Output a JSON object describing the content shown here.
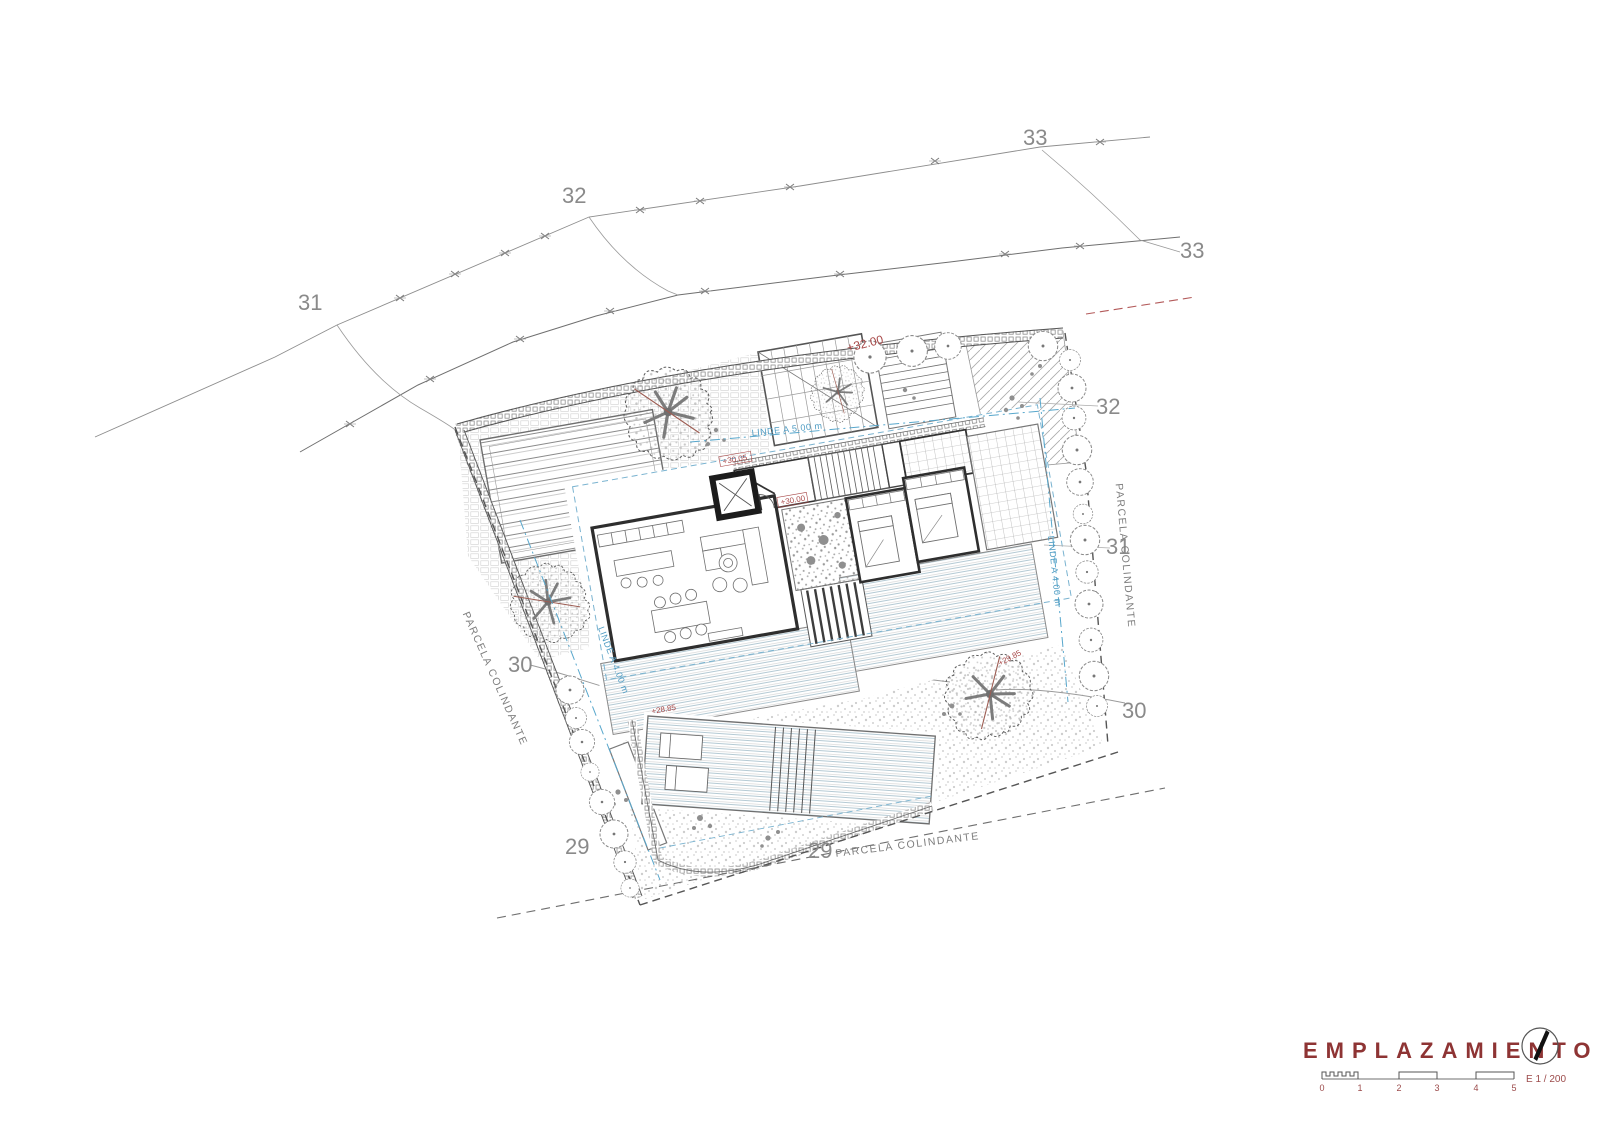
{
  "labels": {
    "contour_31_left": "31",
    "contour_32_top": "32",
    "contour_33_top": "33",
    "contour_33_right": "33",
    "contour_32_right": "32",
    "contour_31_right": "31",
    "contour_30_right": "30",
    "contour_30_left": "30",
    "contour_29_left": "29",
    "contour_29_bottom": "29",
    "contour_30_garden": "30",
    "parcela_left": "PARCELA COLINDANTE",
    "parcela_right": "PARCELA COLINDANTE",
    "parcela_bottom": "PARCELA COLINDANTE",
    "linde_top": "LINDE A 5.00 m",
    "linde_left": "LINDE A 4.00 m",
    "linde_right": "LINDE A 4.00 m"
  },
  "annotations": {
    "cota_top": "+32.00",
    "cota_entrance": "+30.05",
    "cota_hall": "+30.00",
    "cota_garden": "+28.85",
    "cota_tree": "+29.85"
  },
  "titleblock": {
    "title": "EMPLAZAMIENTO",
    "scale_label": "E 1 / 200",
    "scale_ticks": [
      "0",
      "1",
      "2",
      "3",
      "4",
      "5"
    ]
  },
  "colors": {
    "annotation_red": "#a84848",
    "title_red": "#8e3434",
    "setback_blue": "#4f9cc3",
    "line_gray": "#6f6f6f",
    "label_gray": "#8a8a8a"
  }
}
